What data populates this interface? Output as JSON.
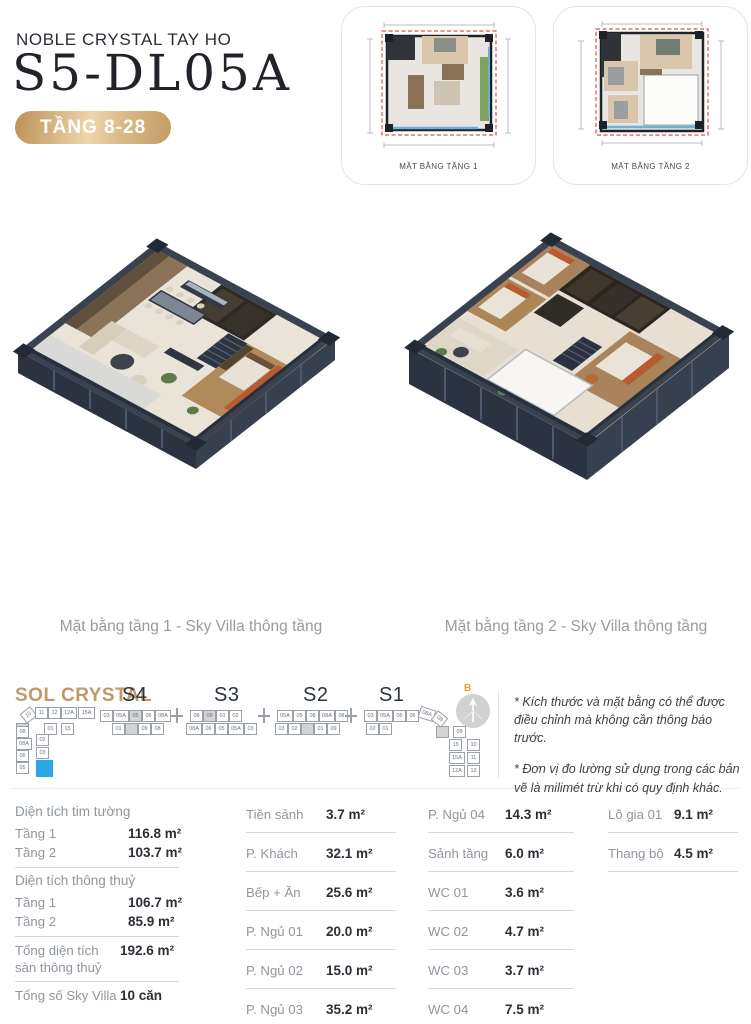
{
  "palette": {
    "gold": "#C79C63",
    "gold_light": "#EBD2A6",
    "text_dark": "#24242C",
    "label_gray": "#8F969E",
    "caption_gray": "#9B9B9B",
    "brand_tan": "#C0996B",
    "highlight_blue": "#2AA9E0",
    "compass_orange": "#EF9B2D",
    "plan_dashed_red": "#D9544A"
  },
  "header": {
    "project": "NOBLE CRYSTAL TAY HO",
    "unit_code": "S5-DL05A",
    "floor_badge": "TẦNG 8-28"
  },
  "thumbnails": [
    {
      "label": "MẶT BẰNG TẦNG 1"
    },
    {
      "label": "MẶT BẰNG TẦNG 2"
    }
  ],
  "captions": [
    "Mặt bằng tầng 1 - Sky Villa thông tầng",
    "Mặt bằng tầng 2 - Sky Villa thông tầng"
  ],
  "locator": {
    "label": "SOL CRYSTAL",
    "compass": "B",
    "sections": [
      {
        "name": "S4",
        "x": 122
      },
      {
        "name": "S3",
        "x": 214
      },
      {
        "name": "S2",
        "x": 303
      },
      {
        "name": "S1",
        "x": 379
      }
    ],
    "blocks": [
      {
        "x": 100,
        "bx": 112,
        "top": [
          "03",
          "05A",
          "05",
          "06",
          "08A"
        ],
        "bottom": [
          "01",
          "",
          "09",
          "08"
        ],
        "gray_top": [
          2
        ],
        "gray_bottom": [
          1
        ]
      },
      {
        "x": 190,
        "bx": 186,
        "top": [
          "08",
          "09",
          "01",
          "02"
        ],
        "bottom": [
          "08A",
          "06",
          "05",
          "05A",
          "03"
        ],
        "gray_top": [
          1
        ],
        "gray_bottom": []
      },
      {
        "x": 277,
        "bx": 275,
        "top": [
          "05A",
          "05",
          "08",
          "08A",
          "08"
        ],
        "bottom": [
          "03",
          "02",
          "",
          "01",
          "09"
        ],
        "gray_top": [],
        "gray_bottom": [
          2
        ]
      },
      {
        "x": 364,
        "bx": 366,
        "top": [
          "03",
          "05A",
          "05",
          "06"
        ],
        "bottom": [
          "02",
          "01"
        ],
        "gray_top": [],
        "gray_bottom": []
      }
    ],
    "connectors": [
      176,
      263,
      350
    ],
    "left_wing": {
      "diag": [
        {
          "l": "10",
          "x": 22,
          "y": 5,
          "r": -38
        },
        {
          "l": "11",
          "x": 35,
          "y": 3
        },
        {
          "l": "12",
          "x": 48,
          "y": 3
        },
        {
          "l": "12A",
          "x": 61,
          "y": 3,
          "w": 16
        },
        {
          "l": "15A",
          "x": 78,
          "y": 3,
          "w": 17
        }
      ],
      "cells": [
        {
          "l": "01",
          "x": 44,
          "y": 19
        },
        {
          "l": "15",
          "x": 61,
          "y": 19
        },
        {
          "l": "",
          "x": 16,
          "y": 19,
          "gray": true
        },
        {
          "l": "08",
          "x": 16,
          "y": 22
        },
        {
          "l": "08A",
          "x": 16,
          "y": 34,
          "w": 16
        },
        {
          "l": "06",
          "x": 16,
          "y": 46
        },
        {
          "l": "05",
          "x": 16,
          "y": 58
        },
        {
          "l": "02",
          "x": 36,
          "y": 30
        },
        {
          "l": "03",
          "x": 36,
          "y": 43
        }
      ],
      "highlight": {
        "x": 36,
        "y": 56,
        "w": 17,
        "h": 17
      }
    },
    "right_wing": {
      "diag": [
        {
          "l": "08A",
          "x": 419,
          "y": 4,
          "r": 18,
          "w": 16
        },
        {
          "l": "08",
          "x": 433,
          "y": 9,
          "r": 38
        }
      ],
      "cells": [
        {
          "l": "",
          "x": 436,
          "y": 22,
          "gray": true
        },
        {
          "l": "09",
          "x": 453,
          "y": 22
        },
        {
          "l": "15",
          "x": 449,
          "y": 35
        },
        {
          "l": "15A",
          "x": 449,
          "y": 48,
          "w": 16
        },
        {
          "l": "12A",
          "x": 449,
          "y": 61,
          "w": 16
        },
        {
          "l": "10",
          "x": 467,
          "y": 35
        },
        {
          "l": "11",
          "x": 467,
          "y": 48
        },
        {
          "l": "12",
          "x": 467,
          "y": 61
        }
      ]
    }
  },
  "notes": [
    "* Kích thước và mặt bằng có thể được điều chỉnh mà không cần thông báo trước.",
    "* Đơn vị đo lường sử dụng trong các bản vẽ là milimét trừ khi có quy định khác."
  ],
  "areas": {
    "summary": [
      {
        "title": "Diện tích tim tường",
        "rows": [
          {
            "label": "Tầng 1",
            "value": "116.8 m²"
          },
          {
            "label": "Tầng 2",
            "value": "103.7 m²"
          }
        ]
      },
      {
        "title": "Diện tích thông thuỷ",
        "rows": [
          {
            "label": "Tầng 1",
            "value": "106.7 m²"
          },
          {
            "label": "Tầng 2",
            "value": "85.9 m²"
          }
        ]
      },
      {
        "rows": [
          {
            "label": "Tổng diện tích sàn thông thuỷ",
            "value": "192.6 m²",
            "tall": true
          }
        ]
      },
      {
        "rows": [
          {
            "label": "Tổng số Sky Villa",
            "value": "10 căn",
            "tall": true
          }
        ]
      }
    ],
    "columns": [
      [
        {
          "label": "Tiền sảnh",
          "value": "3.7 m²"
        },
        {
          "label": "P. Khách",
          "value": "32.1 m²"
        },
        {
          "label": "Bếp + Ăn",
          "value": "25.6 m²"
        },
        {
          "label": "P. Ngủ 01",
          "value": "20.0 m²"
        },
        {
          "label": "P. Ngủ 02",
          "value": "15.0 m²"
        },
        {
          "label": "P. Ngủ 03",
          "value": "35.2 m²"
        }
      ],
      [
        {
          "label": "P. Ngủ 04",
          "value": "14.3 m²"
        },
        {
          "label": "Sảnh tầng",
          "value": "6.0 m²"
        },
        {
          "label": "WC 01",
          "value": "3.6 m²"
        },
        {
          "label": "WC 02",
          "value": "4.7 m²"
        },
        {
          "label": "WC 03",
          "value": "3.7 m²"
        },
        {
          "label": "WC 04",
          "value": "7.5 m²"
        }
      ],
      [
        {
          "label": "Lô gia 01",
          "value": "9.1 m²"
        },
        {
          "label": "Thang bộ",
          "value": "4.5 m²"
        }
      ]
    ]
  }
}
